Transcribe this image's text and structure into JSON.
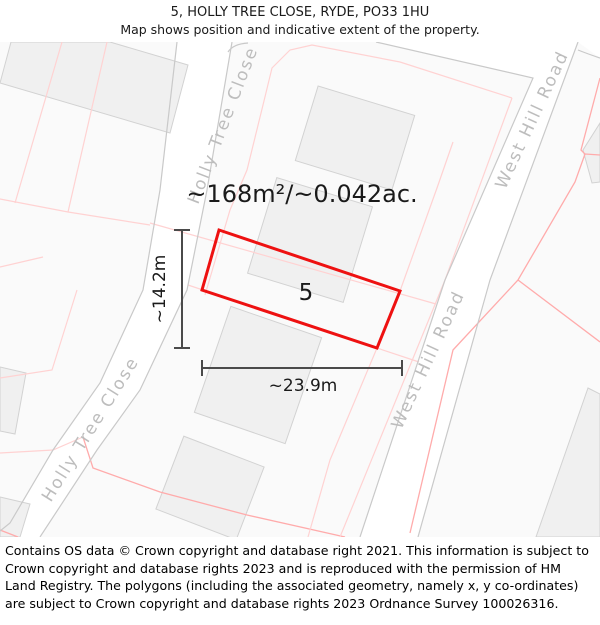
{
  "header": {
    "title": "5, HOLLY TREE CLOSE, RYDE, PO33 1HU",
    "subtitle": "Map shows position and indicative extent of the property."
  },
  "map": {
    "area_label": "~168m²/~0.042ac.",
    "plot_number": "5",
    "width_label": "~23.9m",
    "height_label": "~14.2m",
    "roads": {
      "holly_tree_close": "Holly Tree Close",
      "west_hill_road": "West Hill Road"
    }
  },
  "footer": {
    "copyright": "Contains OS data © Crown copyright and database right 2021. This information is subject to Crown copyright and database rights 2023 and is reproduced with the permission of HM Land Registry. The polygons (including the associated geometry, namely x, y co-ordinates) are subject to Crown copyright and database rights 2023 Ordnance Survey 100026316."
  },
  "colors": {
    "property-outline": "#ee1111",
    "parcel-line": "#ffd2d2",
    "parcel-line-strong": "#ffabab",
    "road-edge": "#c9c9c9",
    "road-fill": "#ffffff",
    "building-fill": "#f0f0f0",
    "building-edge": "#d2d2d2",
    "map-bg": "#fafafa",
    "road-label": "#bdbdbd",
    "dimension": "#4a4a4a",
    "text": "#1a1a1a"
  }
}
